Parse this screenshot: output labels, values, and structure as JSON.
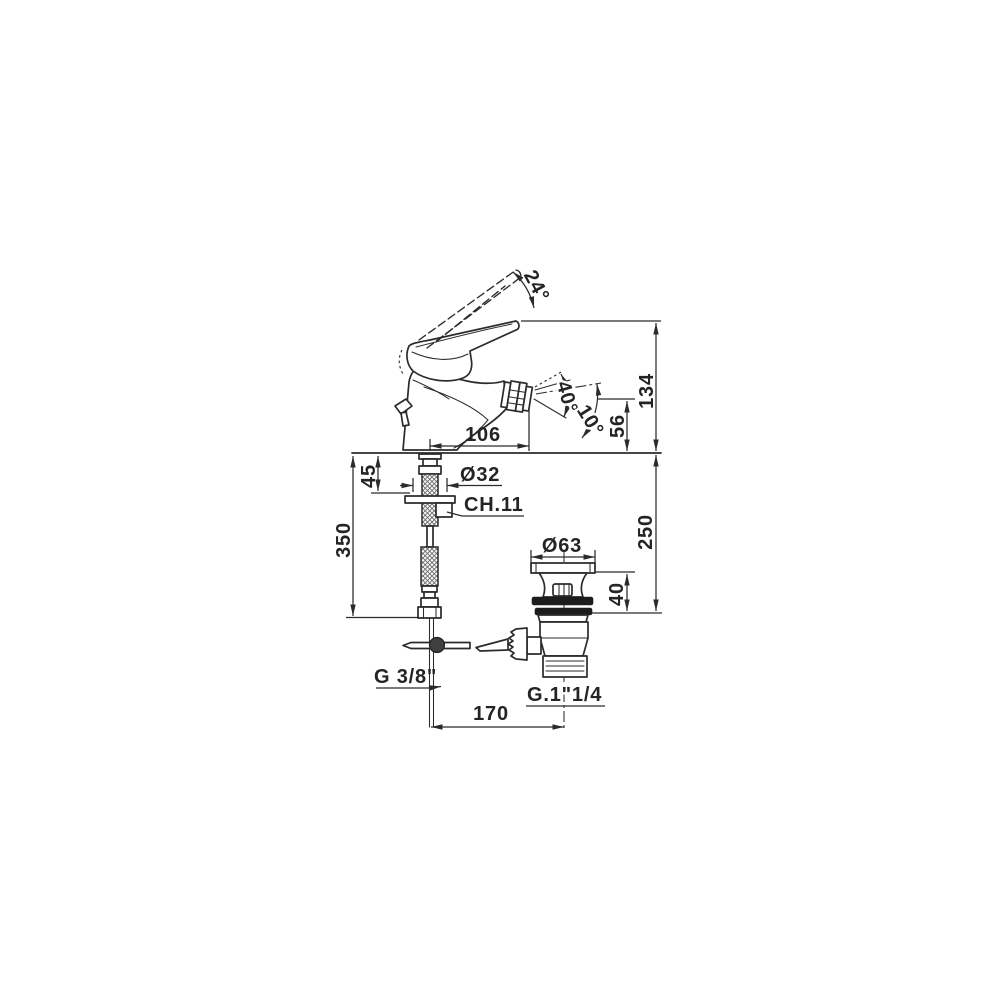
{
  "page": {
    "background": "#ffffff"
  },
  "drawing": {
    "name": "bidet-mixer-technical-drawing",
    "description": "Dimensional side view of a single-lever bidet mixer with flexible supply hose and pop-up waste",
    "stroke_color": "#2b2b2b",
    "labels": {
      "handle_angle": "24°",
      "overall_height": "134",
      "spout_height": "56",
      "spray_angle": "40°",
      "spray_tilt": "10°",
      "spout_reach": "106",
      "deck_thickness": "45",
      "hole_dia": "Ø32",
      "wrench": "CH.11",
      "hose_length": "350",
      "waste_dia": "Ø63",
      "waste_height": "40",
      "under_depth": "250",
      "inlet_thread": "G 3/8\"",
      "waste_thread": "G.1\"1/4",
      "centres": "170"
    }
  }
}
